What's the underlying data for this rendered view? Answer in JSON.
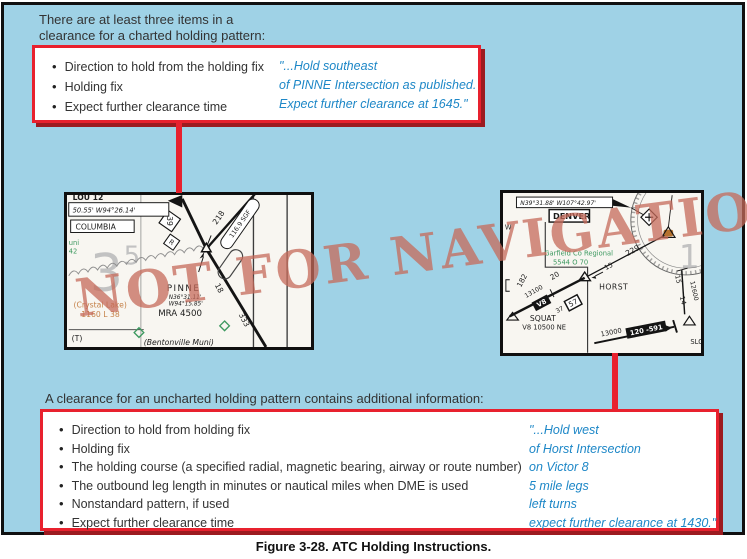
{
  "colors": {
    "background_blue": "#9fd2e6",
    "box_red": "#e8212e",
    "box_shadow_red": "#9c1b20",
    "quote_blue": "#1d87c7",
    "watermark_salmon": "#c66a5a",
    "chart_paper": "#f8f6f1",
    "chart_green": "#3d9960",
    "chart_orange": "#c58148"
  },
  "intro_top": {
    "line1": "There are at least three items in a",
    "line2": "clearance for a charted holding pattern:"
  },
  "top_box": {
    "bullets": [
      "Direction to hold from the holding fix",
      "Holding fix",
      "Expect further clearance time"
    ],
    "quote_lines": [
      "\"...Hold southeast",
      "of PINNE Intersection as published.",
      "Expect further clearance at 1645.\""
    ]
  },
  "intro_bottom": "A clearance for an uncharted holding pattern contains additional information:",
  "bottom_box": {
    "bullets": [
      "Direction to hold from holding fix",
      "Holding fix",
      "The holding course (a specified radial, magnetic bearing, airway or route number)",
      "The outbound leg length in minutes or nautical miles when DME is used",
      "Nonstandard pattern, if used",
      "Expect further clearance time"
    ],
    "quote_lines": [
      "\"...Hold west",
      "of Horst Intersection",
      "on Victor 8",
      "5 mile legs",
      "left turns",
      "expect further clearance at 1430.\""
    ]
  },
  "watermark": "NOT FOR NAVIGATION",
  "caption": "Figure 3-28. ATC Holding Instructions.",
  "charts": {
    "left": {
      "partial_top": "LOU 12",
      "coords": "50.55' W94°26.14'",
      "columbia": "COLUMBIA",
      "muni1": "uni",
      "muni2": "42",
      "grid3": "3",
      "grid5": "5",
      "box39": "39",
      "boxR": "R",
      "awy218": "218",
      "navaid": "116.9 SGF",
      "awy18": "18",
      "awy333": "333",
      "fix": "PINNE",
      "fix_lat": "N36°31.11'",
      "fix_lon": "W94°15.85'",
      "mra": "MRA 4500",
      "lake1": "(Crystal Lake)",
      "lake2": "1160 L 38",
      "t": "(T)",
      "muni3": "(Bentonville Muni)"
    },
    "right": {
      "coords": "N39°31.88' W107°42.97'",
      "denver": "DENVER",
      "w": "W",
      "apt1": "Garfield Co Regional",
      "apt2": "5544 O 70",
      "awy229": "229",
      "d15a": "15",
      "fix": "HORST",
      "awy182": "182",
      "alt13100": "13100",
      "d20": "20",
      "v8": "V8",
      "box57": "57",
      "d37": "37",
      "squat1": "SQUAT",
      "squat2": "V8 10500 NE",
      "alt13000": "13000",
      "mea": "120 -591",
      "r15": "15",
      "alt12600": "12600",
      "d14": "14",
      "slo": "SLO",
      "grid16": "16"
    }
  }
}
